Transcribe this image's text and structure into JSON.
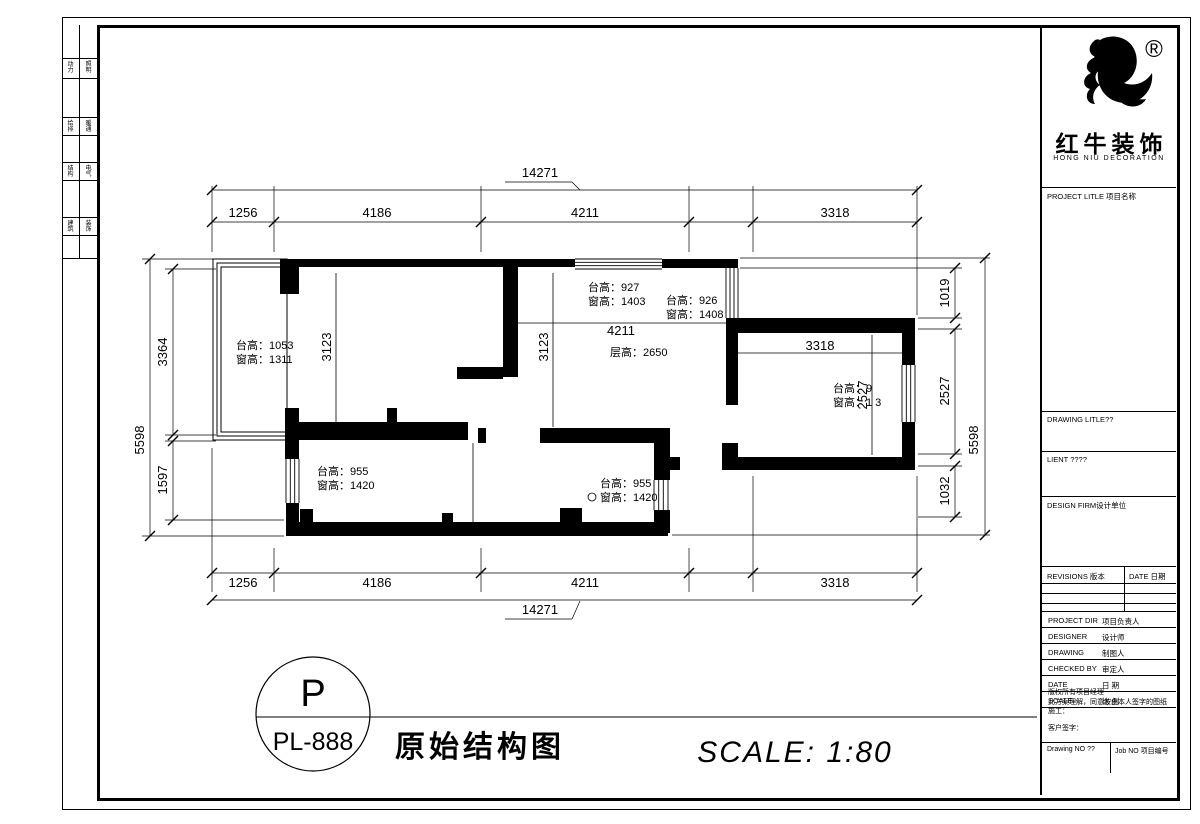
{
  "logo": {
    "brand_cn": "红牛装饰",
    "brand_en": "HONG NIU DECORATION",
    "registered_mark": "®"
  },
  "left_strip": {
    "cells": [
      [
        "动力",
        "照明"
      ],
      [
        "给排",
        "暖通"
      ],
      [
        "结构",
        "电气"
      ],
      [
        "建筑",
        "装饰"
      ]
    ]
  },
  "sidebar": {
    "project_title_label": "PROJECT LITLE 项目名称",
    "drawing_title_label": "DRAWING LITLE??",
    "client_label": "LIENT ????",
    "design_firm_label": "DESIGN FIRM设计单位",
    "revisions_label": "REVISIONS 版本",
    "revisions_date_label": "DATE 日期",
    "fields": [
      {
        "en": "PROJECT DIR",
        "cn": "项目负责人"
      },
      {
        "en": "DESIGNER",
        "cn": "设计师"
      },
      {
        "en": "DRAWING",
        "cn": "制图人"
      },
      {
        "en": "CHECKED BY",
        "cn": "审定人"
      },
      {
        "en": "DATE",
        "cn": "日 期"
      },
      {
        "en": "SCALE",
        "cn": "比 例"
      }
    ],
    "authorization_lines": [
      "版权所有项目经理",
      "此方案理解，同意按由本人签字的图纸施工：",
      "客户签字："
    ],
    "drawing_no_label": "Drawing NO ??",
    "job_no_label": "Job NO 项目编号"
  },
  "title_block": {
    "stamp_letter": "P",
    "stamp_code": "PL-888",
    "drawing_title": "原始结构图",
    "scale_text": "SCALE:  1:80"
  },
  "plan": {
    "overall_width_top": "14271",
    "overall_width_bottom": "14271",
    "overall_height_left": "5598",
    "overall_height_right": "5598",
    "top_segments": [
      "1256",
      "4186",
      "4211",
      "3318"
    ],
    "bottom_segments": [
      "1256",
      "4186",
      "4211",
      "3318"
    ],
    "left_segments": [
      "3364",
      "1597"
    ],
    "right_segments": [
      "1019",
      "2527",
      "1032"
    ],
    "interior": {
      "dim_4211": "4211",
      "dim_3318": "3318",
      "dim_3123_left": "3123",
      "dim_3123_mid": "3123",
      "dim_2527": "2527",
      "floor_height": "层高：2650"
    },
    "rooms": {
      "top_left": {
        "sill": "台高：1053",
        "window": "窗高：1311"
      },
      "top_mid_a": {
        "sill": "台高：927",
        "window": "窗高：1403"
      },
      "top_mid_b": {
        "sill": "台高：926",
        "window": "窗高：1408"
      },
      "right": {
        "sill": "台高：9",
        "window": "窗高：1 3"
      },
      "bottom_left": {
        "sill": "台高：955",
        "window": "窗高：1420"
      },
      "bottom_mid": {
        "sill": "台高：955",
        "window": "窗高：1420"
      }
    }
  }
}
